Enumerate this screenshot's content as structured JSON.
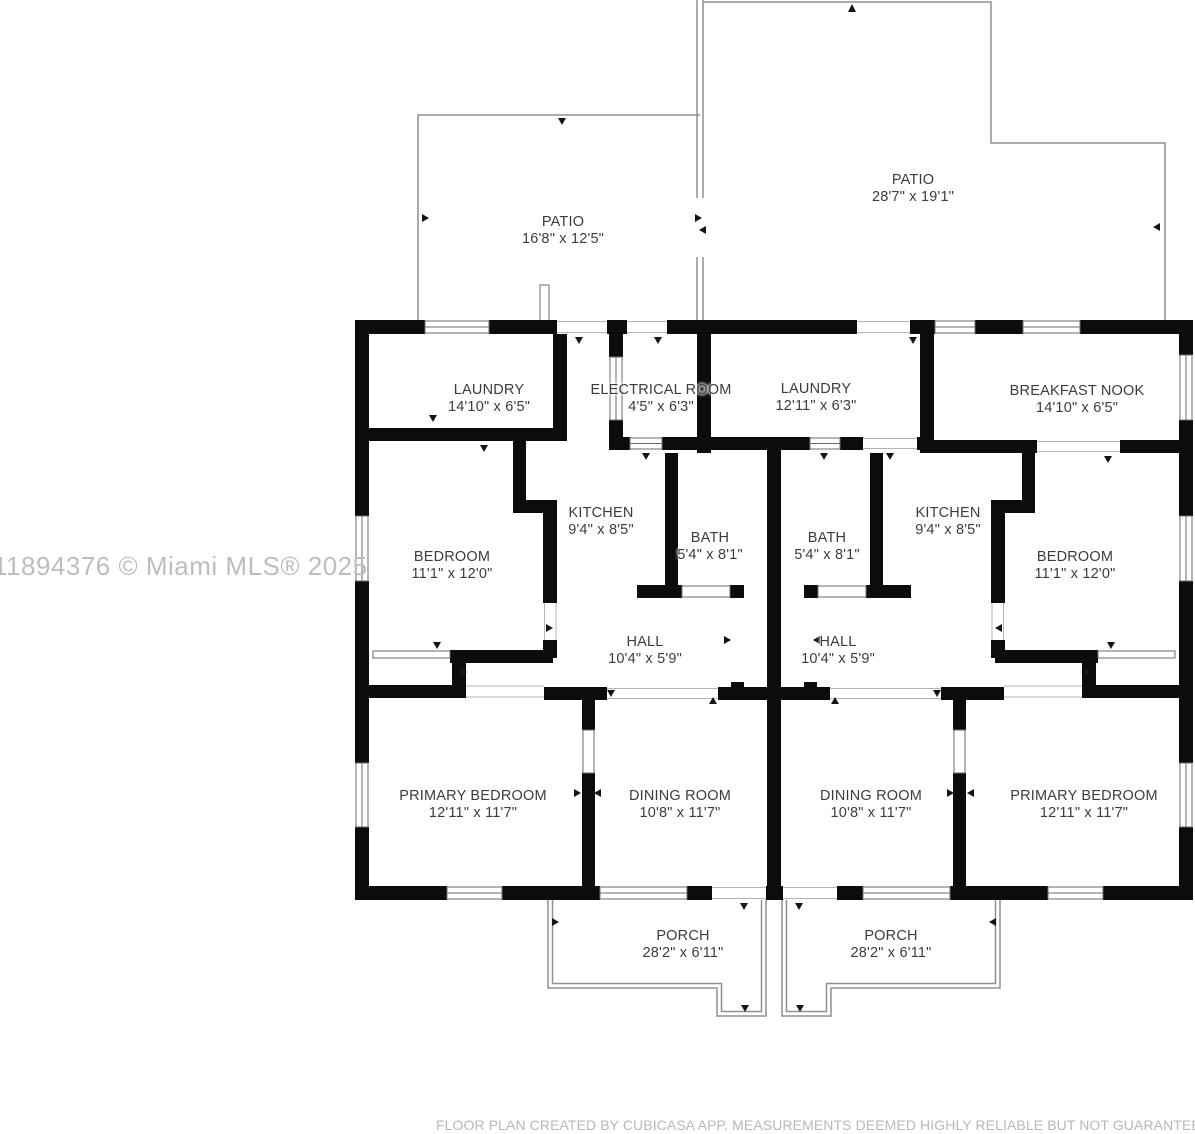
{
  "watermark": "11894376 © Miami MLS® 2025",
  "footer": "FLOOR PLAN CREATED BY CUBICASA APP. MEASUREMENTS DEEMED HIGHLY RELIABLE BUT NOT GUARANTEED.",
  "colors": {
    "wall": "#0c0c0c",
    "label": "#3c3c3c",
    "watermark": "#bdbdbd",
    "outline": "#8f8f8f"
  },
  "rooms": [
    {
      "id": "patio-left",
      "name": "PATIO",
      "dims": "16'8\" x 12'5\""
    },
    {
      "id": "patio-right",
      "name": "PATIO",
      "dims": "28'7\" x 19'1\""
    },
    {
      "id": "laundry-left",
      "name": "LAUNDRY",
      "dims": "14'10\" x 6'5\""
    },
    {
      "id": "electrical-room",
      "name": "ELECTRICAL ROOM",
      "dims": "4'5\" x 6'3\""
    },
    {
      "id": "laundry-right",
      "name": "LAUNDRY",
      "dims": "12'11\" x 6'3\""
    },
    {
      "id": "breakfast-nook",
      "name": "BREAKFAST NOOK",
      "dims": "14'10\" x 6'5\""
    },
    {
      "id": "bedroom-left",
      "name": "BEDROOM",
      "dims": "11'1\" x 12'0\""
    },
    {
      "id": "kitchen-left",
      "name": "KITCHEN",
      "dims": "9'4\" x 8'5\""
    },
    {
      "id": "bath-left",
      "name": "BATH",
      "dims": "5'4\" x 8'1\""
    },
    {
      "id": "bath-right",
      "name": "BATH",
      "dims": "5'4\" x 8'1\""
    },
    {
      "id": "kitchen-right",
      "name": "KITCHEN",
      "dims": "9'4\" x 8'5\""
    },
    {
      "id": "bedroom-right",
      "name": "BEDROOM",
      "dims": "11'1\" x 12'0\""
    },
    {
      "id": "hall-left",
      "name": "HALL",
      "dims": "10'4\" x 5'9\""
    },
    {
      "id": "hall-right",
      "name": "HALL",
      "dims": "10'4\" x 5'9\""
    },
    {
      "id": "primary-bedroom-left",
      "name": "PRIMARY BEDROOM",
      "dims": "12'11\" x 11'7\""
    },
    {
      "id": "dining-room-left",
      "name": "DINING ROOM",
      "dims": "10'8\" x 11'7\""
    },
    {
      "id": "dining-room-right",
      "name": "DINING ROOM",
      "dims": "10'8\" x 11'7\""
    },
    {
      "id": "primary-bedroom-right",
      "name": "PRIMARY BEDROOM",
      "dims": "12'11\" x 11'7\""
    },
    {
      "id": "porch-left",
      "name": "PORCH",
      "dims": "28'2\" x 6'11\""
    },
    {
      "id": "porch-right",
      "name": "PORCH",
      "dims": "28'2\" x 6'11\""
    }
  ]
}
